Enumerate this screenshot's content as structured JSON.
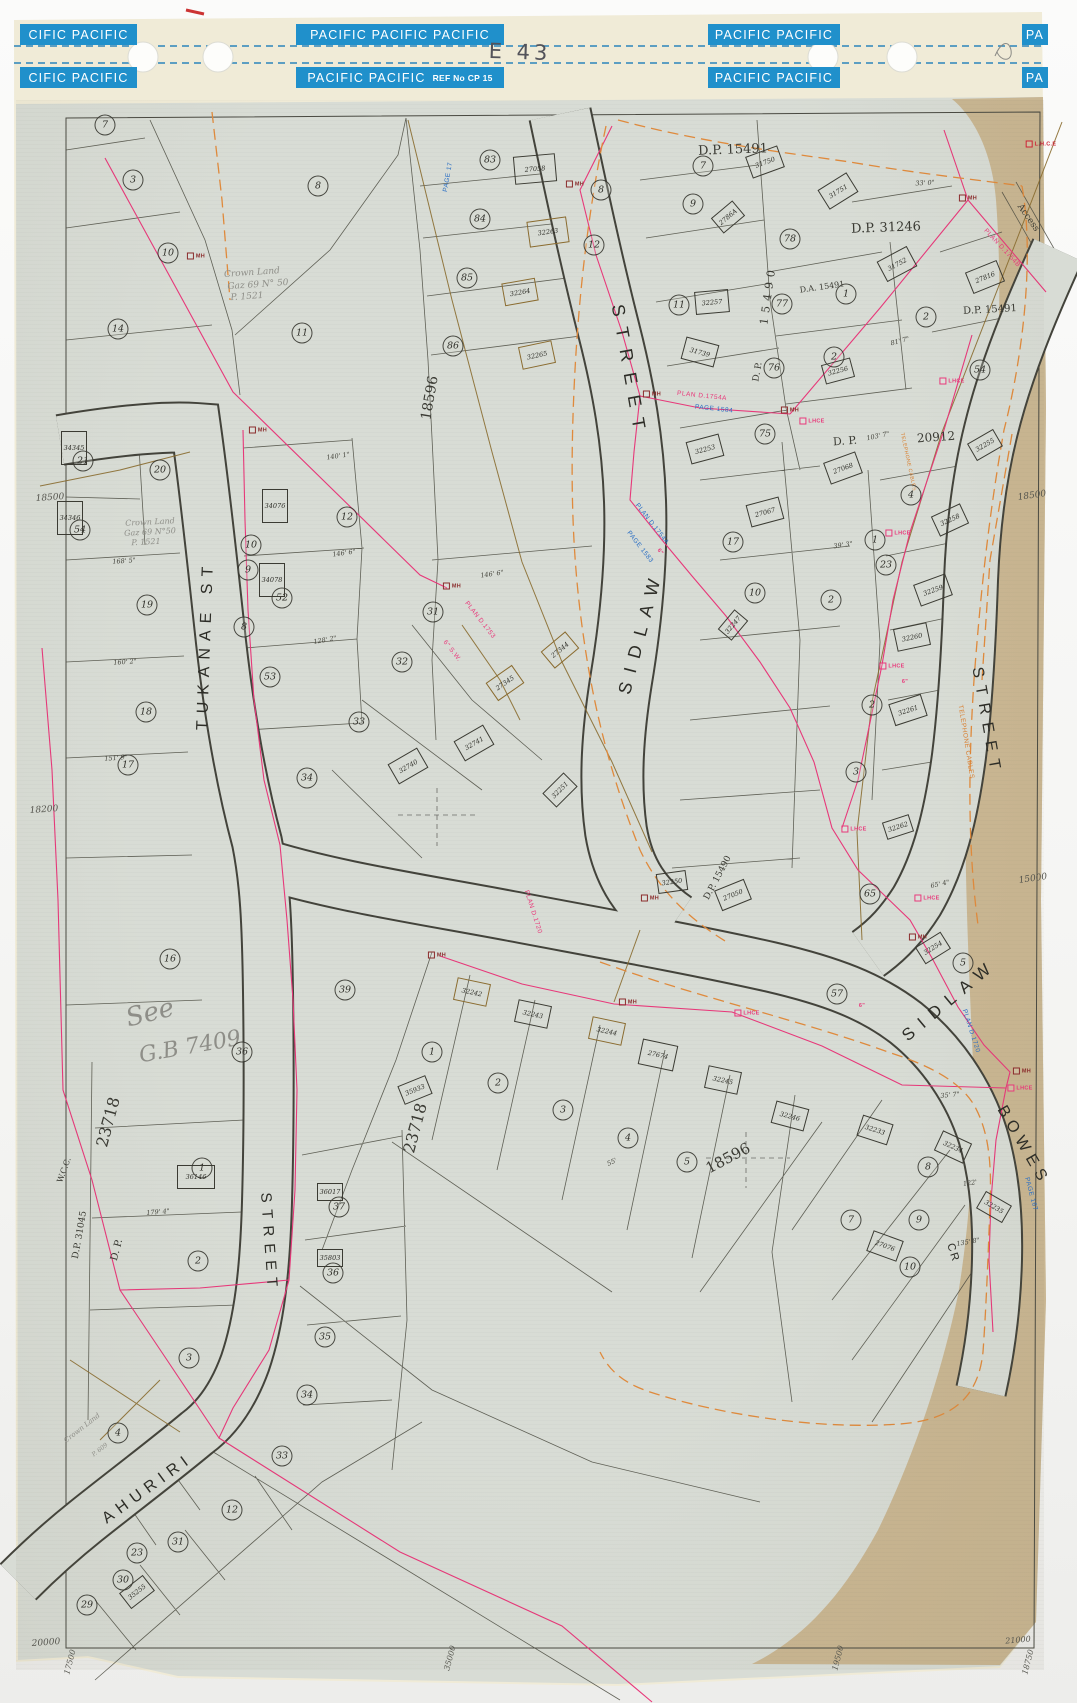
{
  "sheet_code": "E 43",
  "binding": {
    "strips_top": [
      "CIFIC PACIFIC",
      "PACIFIC PACIFIC PACIFIC",
      "PACIFIC PACIFIC",
      "PA"
    ],
    "strips_bottom": [
      "CIFIC PACIFIC",
      "PACIFIC PACIFIC",
      "PACIFIC PACIFIC",
      "PA"
    ],
    "ref_label": "REF No CP 15"
  },
  "colors": {
    "binding_blue": "#2090cb",
    "paper_grey": "#d8dcd5",
    "paper_edge_tan": "#c8b28c",
    "ink": "#3a3a33",
    "survey_pink": "#e8387a",
    "orange": "#e08a3c",
    "olive_brown": "#8a6b2f",
    "blue_ink": "#2b6fc4",
    "pencil": "#8e8e88"
  },
  "streets": [
    {
      "t": "TUKANAE ST",
      "x": 206,
      "y": 645,
      "rot": -88,
      "fs": 16,
      "ls": 7
    },
    {
      "t": "STREET",
      "x": 629,
      "y": 372,
      "rot": 80,
      "fs": 18,
      "ls": 11
    },
    {
      "t": "SIDLAW",
      "x": 641,
      "y": 632,
      "rot": -75,
      "fs": 18,
      "ls": 10
    },
    {
      "t": "STREET",
      "x": 986,
      "y": 722,
      "rot": 80,
      "fs": 16,
      "ls": 8
    },
    {
      "t": "SIDLAW",
      "x": 950,
      "y": 1000,
      "rot": -40,
      "fs": 17,
      "ls": 9
    },
    {
      "t": "BOWES",
      "x": 1023,
      "y": 1146,
      "rot": 60,
      "fs": 16,
      "ls": 6
    },
    {
      "t": "AHURIRI",
      "x": 148,
      "y": 1489,
      "rot": -36,
      "fs": 16,
      "ls": 6
    },
    {
      "t": "STREET",
      "x": 269,
      "y": 1243,
      "rot": 86,
      "fs": 15,
      "ls": 7
    },
    {
      "t": "CR",
      "x": 953,
      "y": 1253,
      "rot": 72,
      "fs": 11,
      "ls": 2
    }
  ],
  "plan_refs": [
    {
      "t": "D.P. 15491",
      "x": 733,
      "y": 150,
      "rot": -2,
      "fs": 13
    },
    {
      "t": "D.P. 31246",
      "x": 886,
      "y": 228,
      "rot": -2,
      "fs": 13
    },
    {
      "t": "D.A. 15491",
      "x": 822,
      "y": 287,
      "rot": -8,
      "fs": 8
    },
    {
      "t": "D.P. 15491",
      "x": 990,
      "y": 310,
      "rot": -3,
      "fs": 10
    },
    {
      "t": "D. P.",
      "x": 845,
      "y": 441,
      "rot": -4,
      "fs": 11
    },
    {
      "t": "20912",
      "x": 936,
      "y": 437,
      "rot": -4,
      "fs": 12
    },
    {
      "t": "D. P.",
      "x": 758,
      "y": 372,
      "rot": -80,
      "fs": 9
    },
    {
      "t": "15490",
      "x": 768,
      "y": 295,
      "rot": -82,
      "fs": 11,
      "ls": 5
    },
    {
      "t": "D.P. 15490",
      "x": 718,
      "y": 878,
      "rot": -62,
      "fs": 9
    },
    {
      "t": "D.P. 31045",
      "x": 80,
      "y": 1235,
      "rot": -80,
      "fs": 9
    },
    {
      "t": "D. P.",
      "x": 117,
      "y": 1250,
      "rot": -75,
      "fs": 10
    },
    {
      "t": "23718",
      "x": 108,
      "y": 1122,
      "rot": -75,
      "fs": 16
    },
    {
      "t": "23718",
      "x": 415,
      "y": 1128,
      "rot": -75,
      "fs": 16
    },
    {
      "t": "18596",
      "x": 430,
      "y": 398,
      "rot": -80,
      "fs": 14
    },
    {
      "t": "18596",
      "x": 728,
      "y": 1158,
      "rot": -28,
      "fs": 15
    },
    {
      "t": "W.C.C.",
      "x": 64,
      "y": 1170,
      "rot": -70,
      "fs": 8
    },
    {
      "t": "Access",
      "x": 1028,
      "y": 218,
      "rot": 55,
      "fs": 9
    }
  ],
  "notes": [
    {
      "t": "Crown Land",
      "x": 252,
      "y": 273,
      "rot": -4,
      "fs": 9
    },
    {
      "t": "Gaz 69   N° 50",
      "x": 258,
      "y": 285,
      "rot": -4,
      "fs": 9
    },
    {
      "t": "P. 1521",
      "x": 247,
      "y": 297,
      "rot": -4,
      "fs": 9
    },
    {
      "t": "Crown Land",
      "x": 150,
      "y": 522,
      "rot": -3,
      "fs": 8
    },
    {
      "t": "Gaz 69 N°50",
      "x": 150,
      "y": 532,
      "rot": -3,
      "fs": 8
    },
    {
      "t": "P. 1521",
      "x": 146,
      "y": 542,
      "rot": -3,
      "fs": 8
    },
    {
      "t": "See",
      "x": 150,
      "y": 1013,
      "rot": -14,
      "fs": 26
    },
    {
      "t": "G.B 7409",
      "x": 190,
      "y": 1047,
      "rot": -10,
      "fs": 22
    },
    {
      "t": "Crown Land",
      "x": 82,
      "y": 1428,
      "rot": -38,
      "fs": 7
    },
    {
      "t": "P. 609",
      "x": 100,
      "y": 1450,
      "rot": -38,
      "fs": 6
    }
  ],
  "small_refs": [
    {
      "t": "PAGE 1584",
      "x": 714,
      "y": 409,
      "rot": 6
    },
    {
      "t": "PLAN D.1754A",
      "x": 702,
      "y": 396,
      "rot": 6,
      "c": "#e8387a"
    },
    {
      "t": "PLAN D.1754A",
      "x": 652,
      "y": 524,
      "rot": 52
    },
    {
      "t": "PAGE 1583",
      "x": 640,
      "y": 547,
      "rot": 52
    },
    {
      "t": "PLAN D.1753",
      "x": 480,
      "y": 620,
      "rot": 52,
      "c": "#e8387a"
    },
    {
      "t": "6\" S.W.",
      "x": 452,
      "y": 651,
      "rot": 52,
      "c": "#e8387a"
    },
    {
      "t": "PLAN D.1720",
      "x": 533,
      "y": 912,
      "rot": 72,
      "c": "#e8387a"
    },
    {
      "t": "PLAN D.1720",
      "x": 971,
      "y": 1031,
      "rot": 72
    },
    {
      "t": "PAGE 167",
      "x": 1031,
      "y": 1194,
      "rot": 75
    },
    {
      "t": "PLAN D.1754B",
      "x": 1002,
      "y": 248,
      "rot": 47,
      "c": "#e8387a"
    },
    {
      "t": "PAGE 17",
      "x": 448,
      "y": 177,
      "rot": -80
    },
    {
      "t": "TELEPHONE CABLES",
      "x": 966,
      "y": 742,
      "rot": 81,
      "c": "#d97e2e"
    },
    {
      "t": "TELEPHONE CABLES",
      "x": 908,
      "y": 462,
      "rot": 78,
      "c": "#d97e2e",
      "fs": 5
    }
  ],
  "coords": [
    {
      "t": "18500",
      "x": 50,
      "y": 498,
      "rot": -4,
      "fs": 9
    },
    {
      "t": "18200",
      "x": 44,
      "y": 810,
      "rot": -4,
      "fs": 9
    },
    {
      "t": "18500",
      "x": 1032,
      "y": 496,
      "rot": -8,
      "fs": 9
    },
    {
      "t": "15000",
      "x": 1033,
      "y": 879,
      "rot": -8,
      "fs": 9
    },
    {
      "t": "20000",
      "x": 46,
      "y": 1643,
      "rot": -4,
      "fs": 9
    },
    {
      "t": "17500",
      "x": 70,
      "y": 1662,
      "rot": -75,
      "fs": 8
    },
    {
      "t": "35000",
      "x": 450,
      "y": 1658,
      "rot": -75,
      "fs": 8
    },
    {
      "t": "19500",
      "x": 838,
      "y": 1658,
      "rot": -75,
      "fs": 8
    },
    {
      "t": "21000",
      "x": 1018,
      "y": 1640,
      "rot": -5,
      "fs": 8
    },
    {
      "t": "18750",
      "x": 1028,
      "y": 1662,
      "rot": -75,
      "fs": 8
    }
  ],
  "dims": [
    {
      "t": "140' 1\"",
      "x": 338,
      "y": 456,
      "rot": -8
    },
    {
      "t": "146' 6\"",
      "x": 344,
      "y": 553,
      "rot": -8
    },
    {
      "t": "128' 2\"",
      "x": 325,
      "y": 640,
      "rot": -10
    },
    {
      "t": "168' 5\"",
      "x": 124,
      "y": 561,
      "rot": -4
    },
    {
      "t": "160' 2\"",
      "x": 125,
      "y": 662,
      "rot": -4
    },
    {
      "t": "151' 9\"",
      "x": 116,
      "y": 758,
      "rot": -4
    },
    {
      "t": "179' 4\"",
      "x": 158,
      "y": 1212,
      "rot": -5
    },
    {
      "t": "33' 0\"",
      "x": 925,
      "y": 183,
      "rot": -3
    },
    {
      "t": "103' 7\"",
      "x": 878,
      "y": 436,
      "rot": -12
    },
    {
      "t": "81' 7\"",
      "x": 900,
      "y": 341,
      "rot": -15
    },
    {
      "t": "39' 3\"",
      "x": 843,
      "y": 545,
      "rot": -8
    },
    {
      "t": "55'",
      "x": 612,
      "y": 1162,
      "rot": -25
    },
    {
      "t": "65' 4\"",
      "x": 940,
      "y": 884,
      "rot": -12
    },
    {
      "t": "122'",
      "x": 970,
      "y": 1183,
      "rot": -8
    },
    {
      "t": "135' 8\"",
      "x": 968,
      "y": 1242,
      "rot": -10
    },
    {
      "t": "146' 6\"",
      "x": 492,
      "y": 574,
      "rot": -8
    },
    {
      "t": "35' 7\"",
      "x": 950,
      "y": 1095,
      "rot": -5
    }
  ],
  "lots": [
    {
      "n": "7",
      "x": 105,
      "y": 125
    },
    {
      "n": "3",
      "x": 133,
      "y": 180
    },
    {
      "n": "10",
      "x": 168,
      "y": 253
    },
    {
      "n": "8",
      "x": 318,
      "y": 186
    },
    {
      "n": "11",
      "x": 302,
      "y": 333
    },
    {
      "n": "14",
      "x": 118,
      "y": 329
    },
    {
      "n": "20",
      "x": 160,
      "y": 470
    },
    {
      "n": "21",
      "x": 83,
      "y": 461
    },
    {
      "n": "54",
      "x": 80,
      "y": 530
    },
    {
      "n": "19",
      "x": 147,
      "y": 605
    },
    {
      "n": "18",
      "x": 146,
      "y": 712
    },
    {
      "n": "17",
      "x": 128,
      "y": 765
    },
    {
      "n": "16",
      "x": 170,
      "y": 959
    },
    {
      "n": "12",
      "x": 347,
      "y": 517
    },
    {
      "n": "52",
      "x": 282,
      "y": 598
    },
    {
      "n": "53",
      "x": 270,
      "y": 677
    },
    {
      "n": "10",
      "x": 251,
      "y": 545
    },
    {
      "n": "9",
      "x": 248,
      "y": 570
    },
    {
      "n": "8",
      "x": 244,
      "y": 627
    },
    {
      "n": "83",
      "x": 490,
      "y": 160
    },
    {
      "n": "84",
      "x": 480,
      "y": 219
    },
    {
      "n": "85",
      "x": 467,
      "y": 278
    },
    {
      "n": "86",
      "x": 453,
      "y": 346
    },
    {
      "n": "8",
      "x": 601,
      "y": 190
    },
    {
      "n": "12",
      "x": 594,
      "y": 245
    },
    {
      "n": "7",
      "x": 703,
      "y": 166
    },
    {
      "n": "9",
      "x": 693,
      "y": 204
    },
    {
      "n": "11",
      "x": 679,
      "y": 305
    },
    {
      "n": "78",
      "x": 790,
      "y": 239
    },
    {
      "n": "77",
      "x": 782,
      "y": 304
    },
    {
      "n": "76",
      "x": 774,
      "y": 368
    },
    {
      "n": "75",
      "x": 765,
      "y": 434
    },
    {
      "n": "1",
      "x": 846,
      "y": 294
    },
    {
      "n": "2",
      "x": 926,
      "y": 317
    },
    {
      "n": "2",
      "x": 834,
      "y": 357
    },
    {
      "n": "54",
      "x": 980,
      "y": 370
    },
    {
      "n": "4",
      "x": 911,
      "y": 495
    },
    {
      "n": "1",
      "x": 875,
      "y": 540
    },
    {
      "n": "17",
      "x": 733,
      "y": 542
    },
    {
      "n": "23",
      "x": 886,
      "y": 565
    },
    {
      "n": "2",
      "x": 831,
      "y": 600
    },
    {
      "n": "10",
      "x": 755,
      "y": 593
    },
    {
      "n": "3",
      "x": 856,
      "y": 772
    },
    {
      "n": "2",
      "x": 872,
      "y": 705
    },
    {
      "n": "31",
      "x": 433,
      "y": 612
    },
    {
      "n": "32",
      "x": 402,
      "y": 662
    },
    {
      "n": "33",
      "x": 359,
      "y": 722
    },
    {
      "n": "34",
      "x": 307,
      "y": 778
    },
    {
      "n": "39",
      "x": 345,
      "y": 990
    },
    {
      "n": "36",
      "x": 242,
      "y": 1052
    },
    {
      "n": "1",
      "x": 432,
      "y": 1052
    },
    {
      "n": "2",
      "x": 498,
      "y": 1083
    },
    {
      "n": "3",
      "x": 563,
      "y": 1110
    },
    {
      "n": "4",
      "x": 628,
      "y": 1138
    },
    {
      "n": "5",
      "x": 687,
      "y": 1162
    },
    {
      "n": "65",
      "x": 870,
      "y": 894
    },
    {
      "n": "57",
      "x": 837,
      "y": 994
    },
    {
      "n": "5",
      "x": 963,
      "y": 963
    },
    {
      "n": "8",
      "x": 928,
      "y": 1167
    },
    {
      "n": "9",
      "x": 919,
      "y": 1220
    },
    {
      "n": "7",
      "x": 851,
      "y": 1220
    },
    {
      "n": "10",
      "x": 910,
      "y": 1267
    },
    {
      "n": "37",
      "x": 339,
      "y": 1207
    },
    {
      "n": "36",
      "x": 333,
      "y": 1273
    },
    {
      "n": "35",
      "x": 325,
      "y": 1337
    },
    {
      "n": "34",
      "x": 307,
      "y": 1395
    },
    {
      "n": "33",
      "x": 282,
      "y": 1456
    },
    {
      "n": "1",
      "x": 202,
      "y": 1168
    },
    {
      "n": "2",
      "x": 198,
      "y": 1261
    },
    {
      "n": "3",
      "x": 189,
      "y": 1358
    },
    {
      "n": "4",
      "x": 118,
      "y": 1433
    },
    {
      "n": "12",
      "x": 232,
      "y": 1510
    },
    {
      "n": "31",
      "x": 178,
      "y": 1542
    },
    {
      "n": "30",
      "x": 123,
      "y": 1580
    },
    {
      "n": "29",
      "x": 87,
      "y": 1605
    },
    {
      "n": "23",
      "x": 137,
      "y": 1553
    }
  ],
  "buildings": [
    {
      "n": "31750",
      "x": 765,
      "y": 162,
      "rot": -20
    },
    {
      "n": "31751",
      "x": 838,
      "y": 191,
      "rot": -32
    },
    {
      "n": "31752",
      "x": 897,
      "y": 264,
      "rot": -28
    },
    {
      "n": "2786A",
      "x": 728,
      "y": 217,
      "rot": -40,
      "w": 26,
      "h": 18
    },
    {
      "n": "27816",
      "x": 985,
      "y": 277,
      "rot": -22
    },
    {
      "n": "32257",
      "x": 712,
      "y": 302,
      "rot": -5
    },
    {
      "n": "31739",
      "x": 700,
      "y": 352,
      "rot": 15
    },
    {
      "n": "27058",
      "x": 535,
      "y": 169,
      "rot": -5,
      "w": 40,
      "h": 26
    },
    {
      "n": "32263",
      "x": 548,
      "y": 232,
      "rot": -8,
      "w": 38,
      "h": 24,
      "bc": "#8a6b2f"
    },
    {
      "n": "32264",
      "x": 520,
      "y": 292,
      "rot": -10,
      "bc": "#8a6b2f"
    },
    {
      "n": "32265",
      "x": 537,
      "y": 355,
      "rot": -12,
      "bc": "#8a6b2f"
    },
    {
      "n": "34076",
      "x": 275,
      "y": 506,
      "rot": 0,
      "w": 24,
      "h": 32
    },
    {
      "n": "34078",
      "x": 272,
      "y": 580,
      "rot": 0,
      "w": 24,
      "h": 32
    },
    {
      "n": "34345",
      "x": 74,
      "y": 448,
      "rot": 0,
      "w": 24,
      "h": 32
    },
    {
      "n": "34346",
      "x": 70,
      "y": 518,
      "rot": 0,
      "w": 24,
      "h": 32
    },
    {
      "n": "32253",
      "x": 705,
      "y": 449,
      "rot": -15
    },
    {
      "n": "27068",
      "x": 843,
      "y": 468,
      "rot": -20
    },
    {
      "n": "27067",
      "x": 765,
      "y": 512,
      "rot": -15
    },
    {
      "n": "32256",
      "x": 838,
      "y": 371,
      "rot": -15,
      "w": 28,
      "h": 18
    },
    {
      "n": "32255",
      "x": 985,
      "y": 445,
      "rot": -30,
      "w": 28,
      "h": 18
    },
    {
      "n": "32258",
      "x": 950,
      "y": 520,
      "rot": -25,
      "w": 30,
      "h": 20
    },
    {
      "n": "32259",
      "x": 933,
      "y": 590,
      "rot": -20
    },
    {
      "n": "32260",
      "x": 912,
      "y": 637,
      "rot": -12
    },
    {
      "n": "32261",
      "x": 908,
      "y": 710,
      "rot": -18
    },
    {
      "n": "32262",
      "x": 898,
      "y": 827,
      "rot": -18,
      "w": 26,
      "h": 16
    },
    {
      "n": "27344",
      "x": 560,
      "y": 650,
      "rot": -40,
      "w": 30,
      "h": 20,
      "bc": "#8a6b2f"
    },
    {
      "n": "27345",
      "x": 505,
      "y": 683,
      "rot": -35,
      "w": 30,
      "h": 20,
      "bc": "#8a6b2f"
    },
    {
      "n": "32741",
      "x": 474,
      "y": 743,
      "rot": -30
    },
    {
      "n": "32740",
      "x": 408,
      "y": 766,
      "rot": -30
    },
    {
      "n": "32247",
      "x": 733,
      "y": 625,
      "rot": -50,
      "w": 24,
      "h": 16
    },
    {
      "n": "32251",
      "x": 560,
      "y": 790,
      "rot": -45,
      "w": 28,
      "h": 18
    },
    {
      "n": "32250",
      "x": 672,
      "y": 882,
      "rot": -8,
      "w": 28,
      "h": 18
    },
    {
      "n": "27050",
      "x": 733,
      "y": 895,
      "rot": -22,
      "w": 30,
      "h": 20
    },
    {
      "n": "32254",
      "x": 933,
      "y": 948,
      "rot": -32,
      "w": 28,
      "h": 18
    },
    {
      "n": "32242",
      "x": 472,
      "y": 992,
      "rot": 12,
      "bc": "#8a6b2f"
    },
    {
      "n": "32243",
      "x": 533,
      "y": 1014,
      "rot": 12
    },
    {
      "n": "32244",
      "x": 607,
      "y": 1031,
      "rot": 12,
      "bc": "#8a6b2f"
    },
    {
      "n": "27674",
      "x": 658,
      "y": 1055,
      "rot": 12,
      "w": 34,
      "h": 24
    },
    {
      "n": "32245",
      "x": 723,
      "y": 1080,
      "rot": 12
    },
    {
      "n": "32246",
      "x": 790,
      "y": 1116,
      "rot": 15
    },
    {
      "n": "32233",
      "x": 875,
      "y": 1130,
      "rot": 18,
      "w": 30,
      "h": 20
    },
    {
      "n": "32234",
      "x": 953,
      "y": 1147,
      "rot": 25,
      "w": 30,
      "h": 20
    },
    {
      "n": "32235",
      "x": 994,
      "y": 1207,
      "rot": 30,
      "w": 28,
      "h": 18
    },
    {
      "n": "27076",
      "x": 885,
      "y": 1246,
      "rot": 20,
      "w": 30,
      "h": 20
    },
    {
      "n": "36146",
      "x": 196,
      "y": 1177,
      "rot": 0,
      "w": 36,
      "h": 22
    },
    {
      "n": "36017",
      "x": 330,
      "y": 1192,
      "rot": 0,
      "w": 24,
      "h": 16
    },
    {
      "n": "35803",
      "x": 330,
      "y": 1258,
      "rot": 0,
      "w": 24,
      "h": 16
    },
    {
      "n": "35933",
      "x": 415,
      "y": 1090,
      "rot": -22,
      "w": 28,
      "h": 18
    },
    {
      "n": "35255",
      "x": 137,
      "y": 1592,
      "rot": -38,
      "w": 28,
      "h": 18
    }
  ],
  "marks": [
    {
      "t": "MH",
      "x": 258,
      "y": 430,
      "c": "#8a2b2b"
    },
    {
      "t": "MH",
      "x": 196,
      "y": 256,
      "c": "#8a2b2b"
    },
    {
      "t": "MH",
      "x": 452,
      "y": 586,
      "c": "#8a2b2b"
    },
    {
      "t": "MH",
      "x": 575,
      "y": 184,
      "c": "#8a2b2b"
    },
    {
      "t": "MH",
      "x": 652,
      "y": 394,
      "c": "#8a2b2b"
    },
    {
      "t": "MH",
      "x": 790,
      "y": 410,
      "c": "#8a2b2b"
    },
    {
      "t": "LHCE",
      "x": 812,
      "y": 421,
      "c": "#e8387a"
    },
    {
      "t": "LHCE",
      "x": 898,
      "y": 533,
      "c": "#e8387a"
    },
    {
      "t": "LHCE",
      "x": 892,
      "y": 666,
      "c": "#e8387a"
    },
    {
      "t": "LHCE",
      "x": 854,
      "y": 829,
      "c": "#e8387a"
    },
    {
      "t": "LHCE",
      "x": 927,
      "y": 898,
      "c": "#e8387a"
    },
    {
      "t": "MH",
      "x": 918,
      "y": 937,
      "c": "#8a2b2b"
    },
    {
      "t": "LHCE",
      "x": 952,
      "y": 381,
      "c": "#e8387a"
    },
    {
      "t": "MH",
      "x": 968,
      "y": 198,
      "c": "#8a2b2b"
    },
    {
      "t": "L.H.C.E",
      "x": 1041,
      "y": 144,
      "c": "#cc2233"
    },
    {
      "t": "LHCE",
      "x": 747,
      "y": 1013,
      "c": "#e8387a"
    },
    {
      "t": "MH",
      "x": 628,
      "y": 1002,
      "c": "#8a2b2b"
    },
    {
      "t": "MH",
      "x": 1022,
      "y": 1071,
      "c": "#8a2b2b"
    },
    {
      "t": "LHCE",
      "x": 1020,
      "y": 1088,
      "c": "#e8387a"
    },
    {
      "t": "MH",
      "x": 650,
      "y": 898,
      "c": "#8a2b2b"
    },
    {
      "t": "MH",
      "x": 437,
      "y": 955,
      "c": "#8a2b2b"
    },
    {
      "t": "6\"",
      "x": 660,
      "y": 552,
      "c": "#e8387a",
      "rot": 52,
      "nb": true
    },
    {
      "t": "6\"",
      "x": 905,
      "y": 682,
      "c": "#e8387a",
      "nb": true
    },
    {
      "t": "6\"",
      "x": 862,
      "y": 1006,
      "c": "#e8387a",
      "nb": true
    }
  ]
}
